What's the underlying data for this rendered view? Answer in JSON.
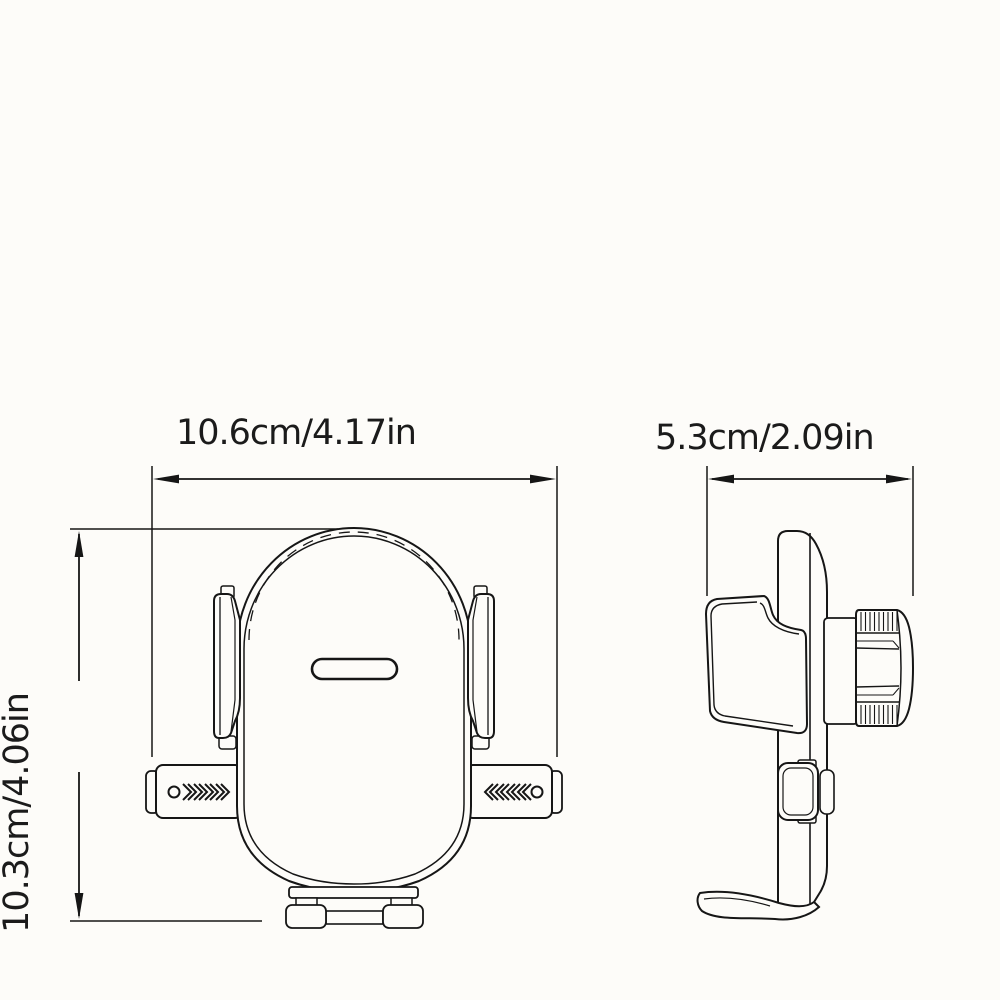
{
  "diagram": {
    "kind": "product-dimension-line-drawing",
    "background_color": "#fdfcf9",
    "line_color": "#161616",
    "text_color": "#1b1b1b",
    "labels": {
      "front_width": "10.6cm/4.17in",
      "side_width": "5.3cm/2.09in",
      "height": "10.3cm/4.06in"
    },
    "icons": {
      "left_arm_marks": "circle-then-right-chevrons",
      "right_arm_marks": "left-chevrons-then-circle"
    }
  }
}
